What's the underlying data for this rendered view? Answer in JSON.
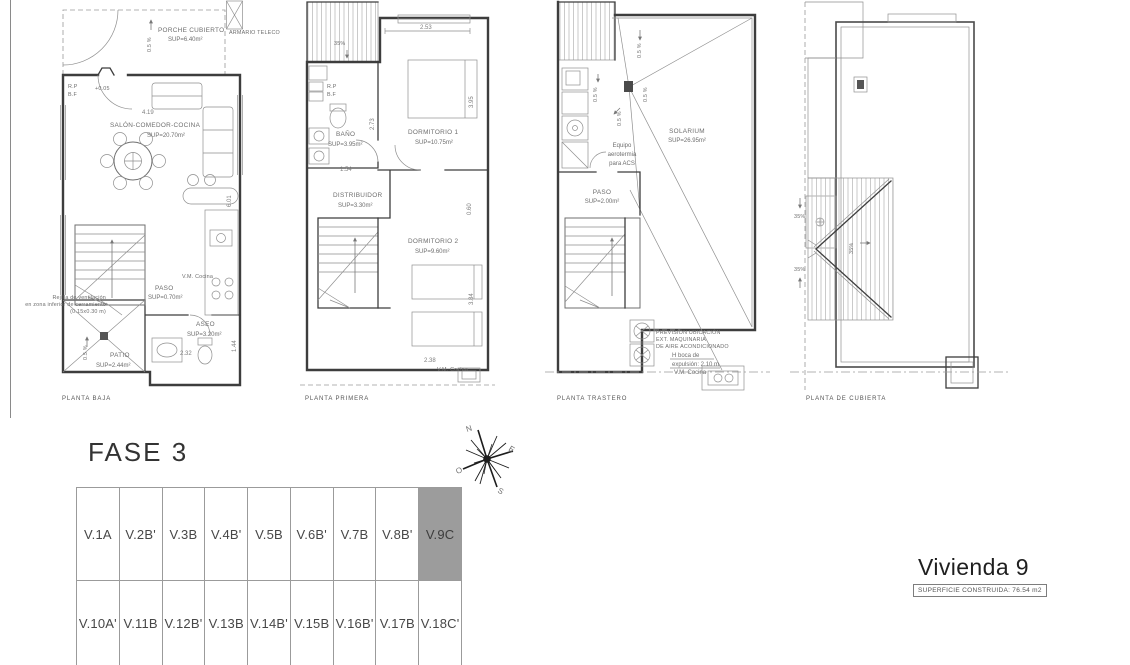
{
  "plans": {
    "baja": {
      "title": "PLANTA BAJA",
      "porche_name": "PORCHE CUBIERTO",
      "porche_sup": "SUP=6.40m²",
      "armario": "ARMARIO TELECO",
      "slope": "0.5 %",
      "rp": "R.P",
      "bf": "B.F",
      "level": "+0.05",
      "salon_name": "SALÓN-COMEDOR-COCINA",
      "salon_sup": "SUP=20.70m²",
      "vm": "V.M. Cocina",
      "paso_name": "PASO",
      "paso_sup": "SUP=0.70m²",
      "aseo_name": "ASEO",
      "aseo_sup": "SUP=3.20m²",
      "rejilla1": "Rejilla de ventilación",
      "rejilla2": "en zona inferior de cerramiento",
      "rejilla3": "(0.15x0.30 m)",
      "patio_name": "PATIO",
      "patio_sup": "SUP=2.44m²",
      "dim_salon_w": "4.19",
      "dim_salon_h": "6.01",
      "dim_aseo_h": "1.44",
      "dim_aseo_w": "2.32"
    },
    "primera": {
      "title": "PLANTA PRIMERA",
      "slope": "35%",
      "dim_top": "2.53",
      "rp": "R.P",
      "bf": "B.F",
      "banyo_name": "BAÑO",
      "banyo_sup": "SUP=3.95m²",
      "dorm1_name": "DORMITORIO 1",
      "dorm1_sup": "SUP=10.75m²",
      "distr_name": "DISTRIBUIDOR",
      "distr_sup": "SUP=3.30m²",
      "dorm2_name": "DORMITORIO 2",
      "dorm2_sup": "SUP=9.60m²",
      "vm": "V.M. Cocina",
      "dim_d1_h": "3.95",
      "dim_banyo_h": "2.73",
      "dim_banyo_w": "1.54",
      "dim_r": "0.60",
      "dim_d2_h": "3.84",
      "dim_bottom": "2.38"
    },
    "trastero": {
      "title": "PLANTA TRASTERO",
      "slope": "0.5 %",
      "solarium_name": "SOLARIUM",
      "solarium_sup": "SUP=26.95m²",
      "equipo1": "Equipo",
      "equipo2": "aerotermia",
      "equipo3": "para ACS",
      "paso_name": "PASO",
      "paso_sup": "SUP=2.00m²",
      "ac1": "PREVISIÓN UBICACIÓN",
      "ac2": "EXT. MAQUINARIA",
      "ac3": "DE AIRE ACONDICIONADO",
      "ac4": "H boca de",
      "ac5": "expulsión: 2.10 m",
      "ac6": "V.M. Cocina"
    },
    "cubierta": {
      "title": "PLANTA DE CUBIERTA",
      "slope": "35%"
    }
  },
  "site": {
    "title": "FASE 3",
    "row1": [
      "V.1A",
      "V.2B'",
      "V.3B",
      "V.4B'",
      "V.5B",
      "V.6B'",
      "V.7B",
      "V.8B'",
      "V.9C"
    ],
    "row2": [
      "V.10A'",
      "V.11B",
      "V.12B'",
      "V.13B",
      "V.14B'",
      "V.15B",
      "V.16B'",
      "V.17B",
      "V.18C'"
    ],
    "highlighted_unit": "V.9C",
    "highlight_color": "#9c9c9c",
    "compass": {
      "n": "N",
      "e": "E",
      "s": "S",
      "o": "O"
    }
  },
  "unit": {
    "title": "Vivienda 9",
    "area_label": "SUPERFICIE CONSTRUIDA: 76.54 m2"
  }
}
